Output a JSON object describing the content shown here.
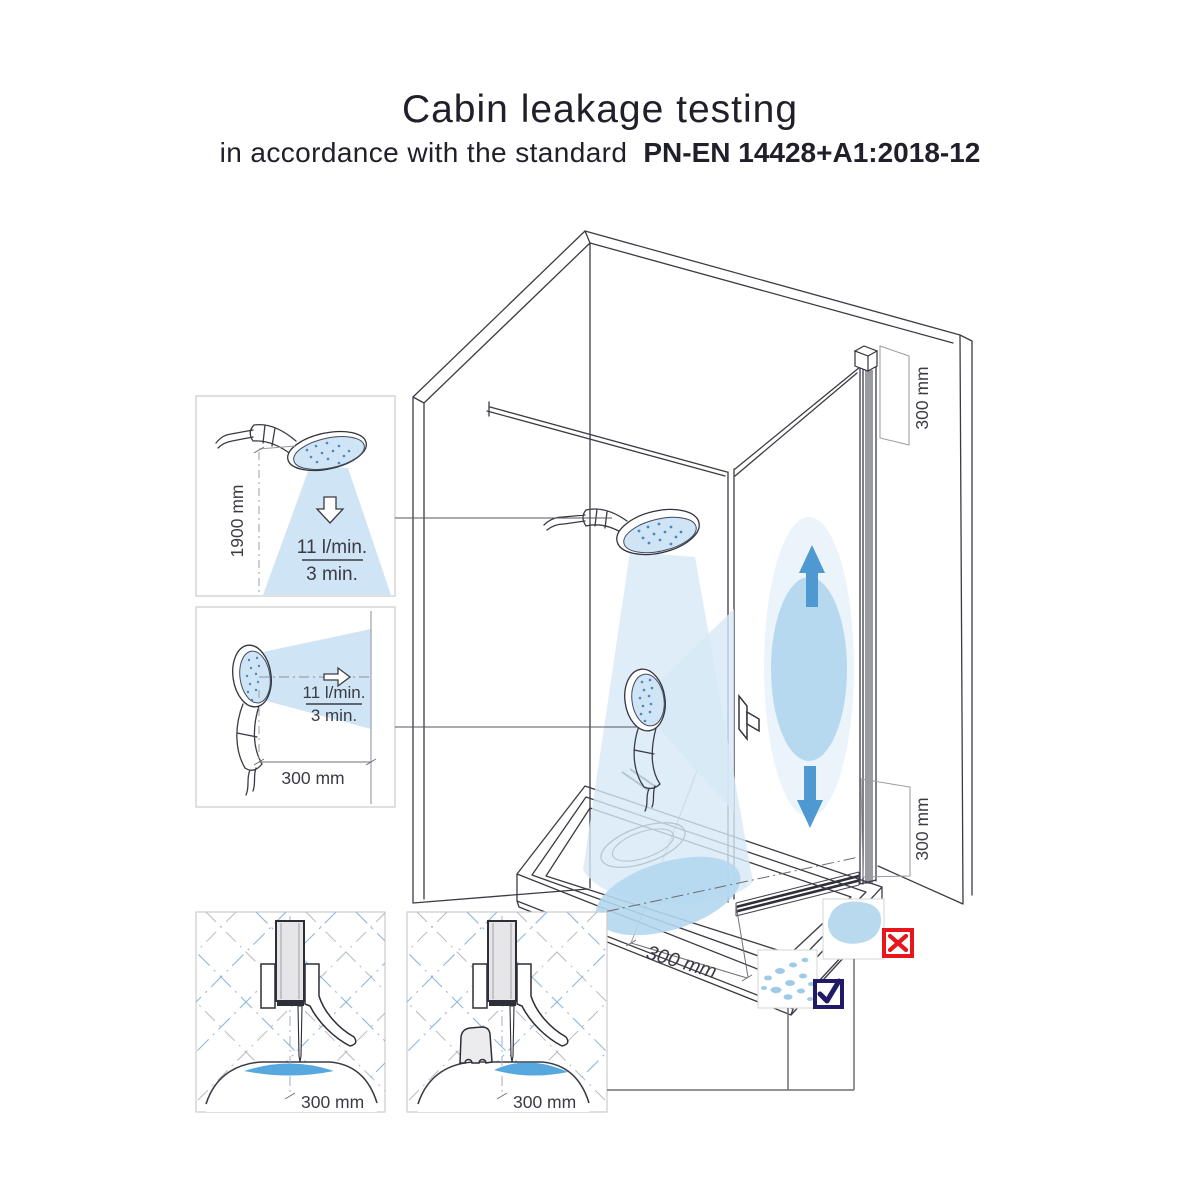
{
  "title": {
    "line1": "Cabin leakage testing",
    "line2_prefix": "in accordance with the standard",
    "line2_standard": "PN-EN 14428+A1:2018-12"
  },
  "insets": {
    "vertical_spray": {
      "height": "1900 mm",
      "flow_rate": "11 l/min.",
      "duration": "3 min."
    },
    "horizontal_spray": {
      "distance": "300 mm",
      "flow_rate": "11 l/min.",
      "duration": "3 min."
    },
    "seal_no_threshold": {
      "distance": "300 mm"
    },
    "seal_with_threshold": {
      "distance": "300 mm"
    }
  },
  "cabin": {
    "door_top_dim": "300 mm",
    "door_bottom_dim": "300 mm",
    "tray_dim": "300 mm"
  },
  "legend": {
    "fail_icon": "red-cross",
    "pass_icon": "navy-check"
  },
  "colors": {
    "spray_light": "#d7e9f6",
    "spray_mid": "#b4d7ee",
    "spray_strong": "#58a8e0",
    "arrow_blue": "#4f99d3",
    "fail_red": "#e8151c",
    "pass_navy": "#211a66",
    "line": "#3b3b45",
    "title_text": "#20202b"
  }
}
